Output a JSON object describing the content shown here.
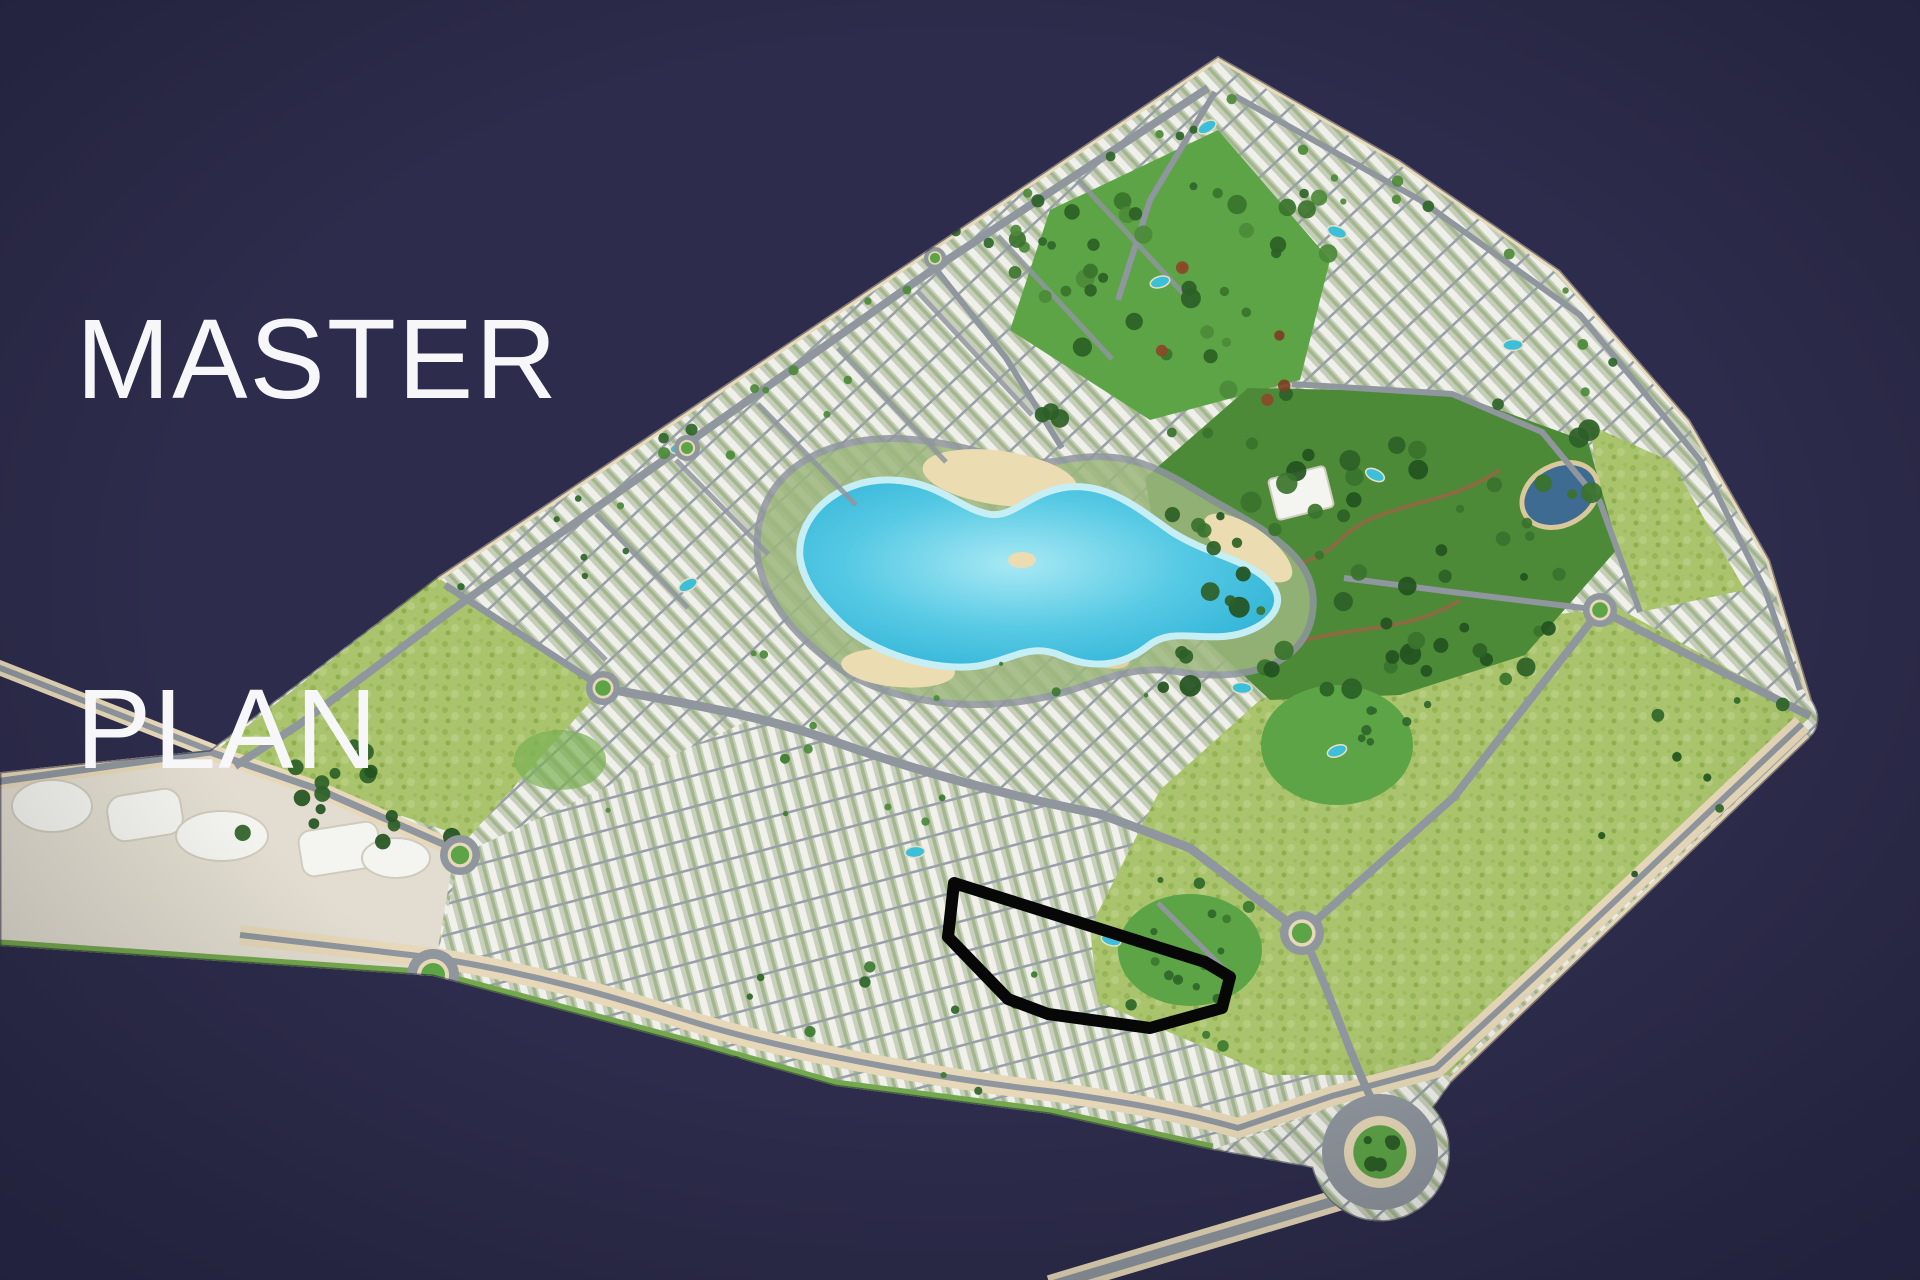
{
  "title": {
    "line1": "MASTER",
    "line2": "PLAN"
  },
  "palette": {
    "background": "#2d2c4c",
    "title_text": "#f7f7fa",
    "land_gap": "#c7cdbb",
    "villa_white": "#eff0e9",
    "field_green": "#a9c46c",
    "lawn_green": "#5da447",
    "forest_green": "#4c8a38",
    "tree_dark": "#2c5f26",
    "water_turquoise": "#50c6e2",
    "pond_blue": "#3d6b92",
    "sand_beige": "#ecdcb2",
    "promenade_beige": "#e6d8b8",
    "road_gray": "#8f969e",
    "grass_edge": "#74a84e",
    "pool_blue": "#3cc0da",
    "building_white": "#f4f4f0",
    "highlight_outline": "#070707"
  },
  "map": {
    "name": "resort-community-master-plan-aerial",
    "regions": [
      {
        "id": "lagoon",
        "label": "central-lagoon"
      },
      {
        "id": "left-field",
        "label": "west-green-parcel"
      },
      {
        "id": "upper-right-field",
        "label": "northeast-green-parcel"
      },
      {
        "id": "lower-right-field",
        "label": "east-green-parcel"
      },
      {
        "id": "forest-park",
        "label": "forest-park-with-pond"
      },
      {
        "id": "top-park",
        "label": "north-park"
      },
      {
        "id": "commercial-strip",
        "label": "southwest-commercial-strip"
      },
      {
        "id": "highlighted-plot",
        "label": "highlighted-villa-cluster"
      }
    ]
  }
}
